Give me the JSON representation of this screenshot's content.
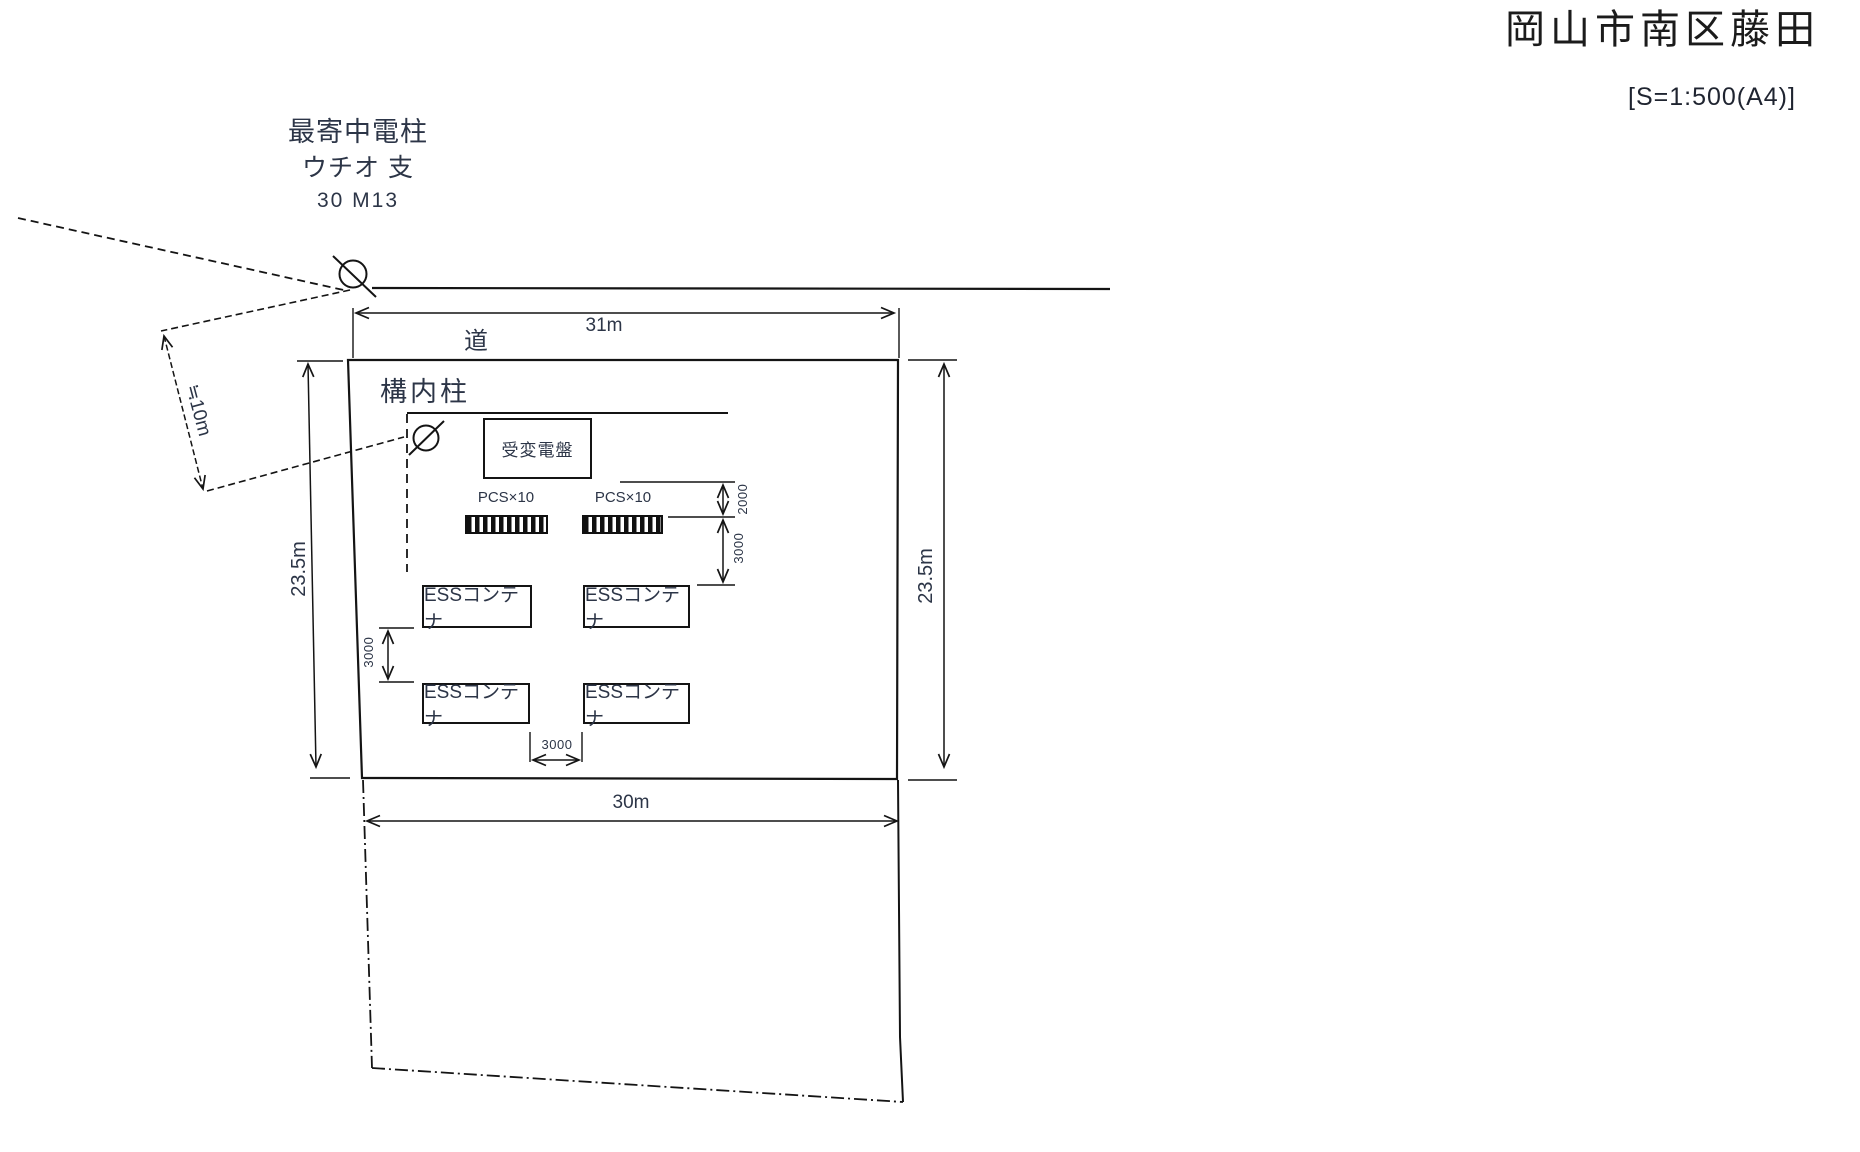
{
  "header": {
    "title": "岡山市南区藤田",
    "scale_note": "[S=1:500(A4)]"
  },
  "nearest_pole": {
    "line1": "最寄中電柱",
    "line2": "ウチオ 支",
    "line3": "30 M13"
  },
  "road": {
    "label": "道"
  },
  "site": {
    "onsite_pole_label": "構内柱",
    "substation_label": "受変電盤",
    "pcs_left_label": "PCS×10",
    "pcs_right_label": "PCS×10",
    "ess_label": "ESSコンテナ"
  },
  "dimensions": {
    "road_frontage": "31m",
    "depth_left": "23.5m",
    "depth_right": "23.5m",
    "bottom_width": "30m",
    "pole_offset": "≒10m",
    "sub_to_pcs_gap": "2000",
    "pcs_to_ess_gap": "3000",
    "ess_row_gap": "3000",
    "ess_col_gap": "3000"
  }
}
